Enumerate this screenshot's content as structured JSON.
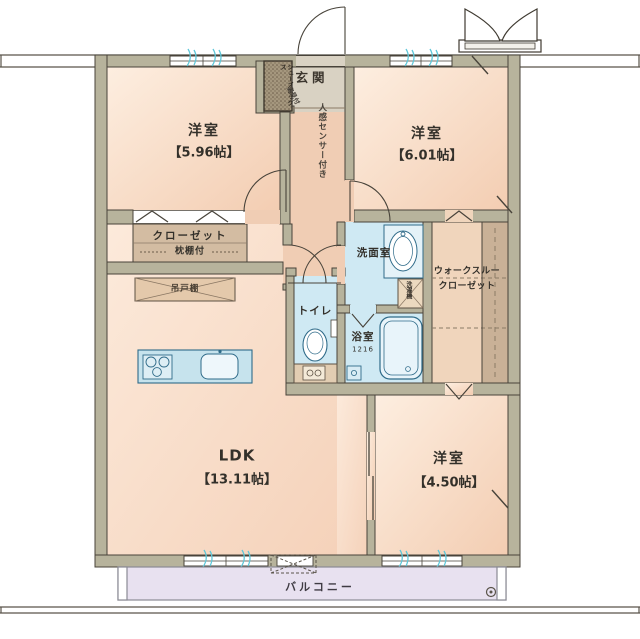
{
  "entrance": {
    "label": "玄関",
    "sensor_note": "人感センサー付き",
    "shoe_box": "シューズボックス",
    "mirror_note": "姿見付"
  },
  "bedroom_nw": {
    "name": "洋室",
    "size": "【5.96帖】"
  },
  "bedroom_ne": {
    "name": "洋室",
    "size": "【6.01帖】"
  },
  "bedroom_se": {
    "name": "洋室",
    "size": "【4.50帖】"
  },
  "ldk": {
    "name": "LDK",
    "size": "【13.11帖】"
  },
  "closet": {
    "label": "クローゼット",
    "note": "枕棚付"
  },
  "walkthrough_closet": {
    "line1": "ウォークスルー",
    "line2": "クローゼット"
  },
  "washroom": {
    "label": "洗面室",
    "laundry": "洗濯機"
  },
  "toilet": {
    "label": "トイレ"
  },
  "bathroom": {
    "label": "浴室",
    "size_code": "1216"
  },
  "kitchen": {
    "hanging_cupboard": "吊戸棚"
  },
  "balcony": {
    "label": "バルコニー"
  },
  "colors": {
    "wall": "#b7b39c",
    "wall_outline": "#48433a",
    "room_floor": "#f8dbc6",
    "hall_floor": "#f0cdb4",
    "wet_room": "#cfe9f3",
    "wet_outline": "#2f6b89",
    "closet_tan": "#d3bca2",
    "genkan_floor": "#d9d2c3",
    "balcony_floor": "#e8e1f0",
    "window_accent": "#5ec7d9"
  }
}
